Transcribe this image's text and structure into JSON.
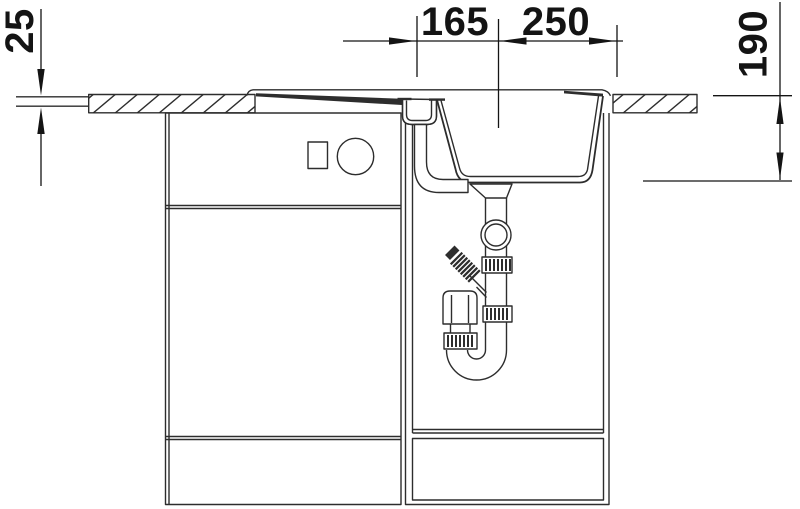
{
  "window": {
    "width": 800,
    "height": 509,
    "background": "#ffffff"
  },
  "diagram": {
    "kind": "technical-line-drawing",
    "subject": "kitchen sink and base cabinet installation cross-section",
    "colors": {
      "line": "#2d2d2d",
      "dimension": "#141414",
      "fill": "#ffffff"
    },
    "dimensions": {
      "top": [
        {
          "name": "drainboard-to-center-span",
          "label": "165"
        },
        {
          "name": "bowl-span",
          "label": "250"
        }
      ],
      "left": {
        "name": "countertop-thickness",
        "label": "25"
      },
      "right": {
        "name": "bowl-depth",
        "label": "190"
      }
    }
  }
}
